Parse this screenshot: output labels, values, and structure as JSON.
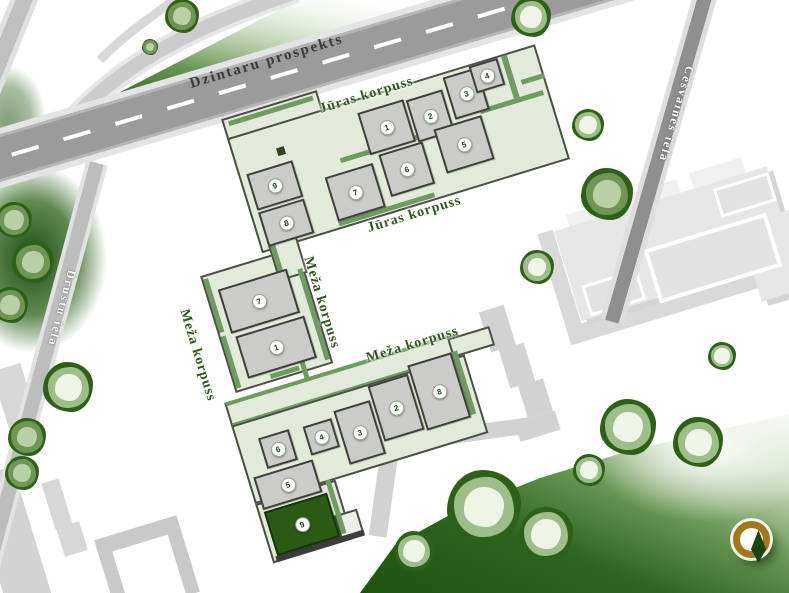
{
  "streets": {
    "dzintaru": {
      "label": "Dzintaru prospekts"
    },
    "cesvaines": {
      "label": "Cēsvaines iela"
    },
    "drustu": {
      "label": "Drustu iela"
    }
  },
  "buildings": {
    "juras": {
      "label": "Jūras korpuss",
      "rooms": [
        {
          "n": "1",
          "x": 110,
          "y": 14,
          "w": 48,
          "h": 44
        },
        {
          "n": "2",
          "x": 160,
          "y": 16,
          "w": 38,
          "h": 44
        },
        {
          "n": "3",
          "x": 202,
          "y": 5,
          "w": 36,
          "h": 44
        },
        {
          "n": "4",
          "x": 230,
          "y": 2,
          "w": 30,
          "h": 28
        },
        {
          "n": "5",
          "x": 178,
          "y": 52,
          "w": 50,
          "h": 46
        },
        {
          "n": "6",
          "x": 118,
          "y": 60,
          "w": 46,
          "h": 44
        },
        {
          "n": "7",
          "x": 60,
          "y": 66,
          "w": 50,
          "h": 46
        },
        {
          "n": "8",
          "x": -14,
          "y": 80,
          "w": 48,
          "h": 36
        },
        {
          "n": "9",
          "x": -14,
          "y": 40,
          "w": 48,
          "h": 38
        }
      ]
    },
    "meza": {
      "label": "Meža korpuss",
      "selected_room": "9",
      "rooms": [
        {
          "n": "7",
          "x": -75,
          "y": 142,
          "w": 72,
          "h": 46
        },
        {
          "n": "1",
          "x": -72,
          "y": 192,
          "w": 72,
          "h": 44
        },
        {
          "n": "6",
          "x": -80,
          "y": 296,
          "w": 32,
          "h": 32
        },
        {
          "n": "4",
          "x": -34,
          "y": 298,
          "w": 30,
          "h": 30
        },
        {
          "n": "3",
          "x": 0,
          "y": 292,
          "w": 38,
          "h": 56
        },
        {
          "n": "2",
          "x": 40,
          "y": 278,
          "w": 42,
          "h": 58
        },
        {
          "n": "8",
          "x": 84,
          "y": 270,
          "w": 46,
          "h": 68
        },
        {
          "n": "5",
          "x": -96,
          "y": 332,
          "w": 62,
          "h": 34
        },
        {
          "n": "9",
          "x": -96,
          "y": 368,
          "w": 66,
          "h": 46,
          "sel": true
        }
      ]
    }
  },
  "icons": {
    "compass": "compass-north"
  },
  "colors": {
    "selected_room": "#2b5a15",
    "room_fill": "#cbccc9",
    "footprint": "#e2ebda",
    "wall_accent": "#6e9b60",
    "label_green": "#2d571b",
    "park_dark": "#1d5510",
    "road_gray": "#9b9b9b",
    "compass_gold": "#a2781d"
  }
}
